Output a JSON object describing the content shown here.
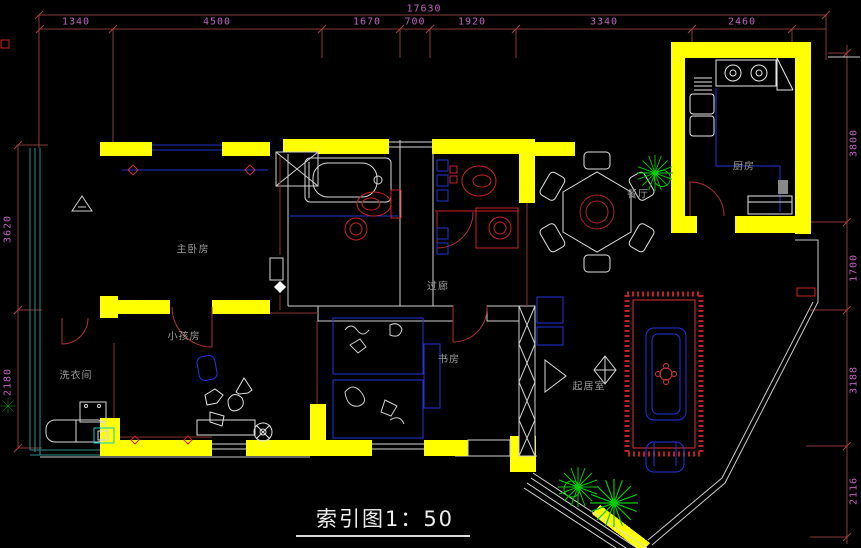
{
  "title_block": {
    "label": "索引图1：50"
  },
  "dimensions": {
    "top_total": "17630",
    "top_chain": [
      "1340",
      "4500",
      "1670",
      "700",
      "1920",
      "3340",
      "2460"
    ],
    "right_chain": [
      "3800",
      "1700",
      "3188",
      "2116"
    ],
    "left_chain": [
      "3620",
      "2180"
    ]
  },
  "rooms": {
    "master_bedroom": "主卧房",
    "kids_room": "小孩房",
    "laundry": "洗衣间",
    "study": "书房",
    "hallway": "过廊",
    "dining": "餐厅",
    "kitchen": "厨房",
    "living_room": "起居室"
  },
  "colors": {
    "background": "#000000",
    "wall_yellow": "#ffff00",
    "dimension_line": "#8a3838",
    "dimension_text": "#c05fc0",
    "room_label": "#9a9a9a",
    "fixture_red": "#cc2222",
    "furniture_blue": "#2233dd",
    "plant_green": "#00cc00",
    "balcony_teal": "#2e8b8b",
    "outline_white": "#d8d8d8",
    "title_text": "#ececec"
  }
}
